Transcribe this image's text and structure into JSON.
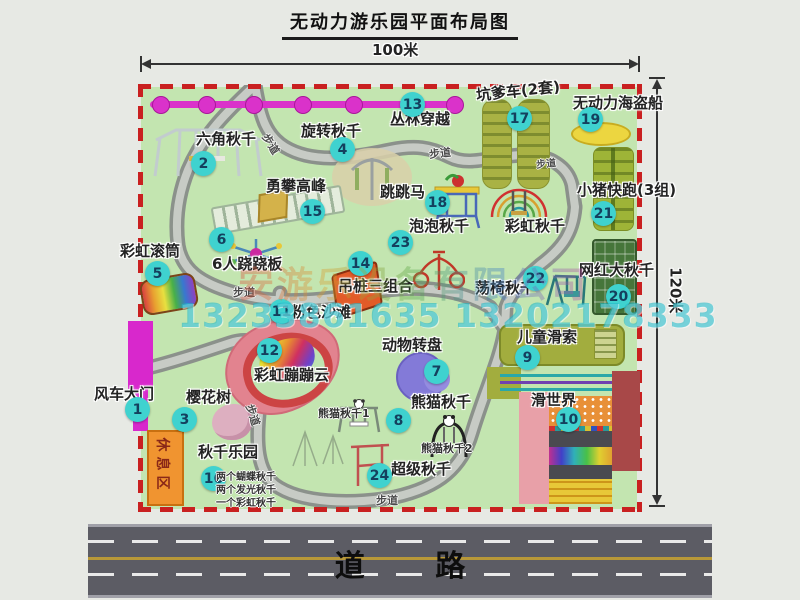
{
  "title": "无动力游乐园平面布局图",
  "dims": {
    "width": "100米",
    "height": "120米"
  },
  "road": {
    "label": "道 路"
  },
  "watermark": {
    "company": "安游乐设备有限公司",
    "phones": "13233861635 13202178333"
  },
  "map": {
    "path_label": "步道",
    "rest_area": "休息区",
    "rainbow_swing_label": "彩虹秋千",
    "panda_swing_1": "熊猫秋千1",
    "panda_swing_2": "熊猫秋千2",
    "swing_park_notes": [
      "两个蝴蝶秋千",
      "两个发光秋千",
      "一个彩虹秋千"
    ]
  },
  "attractions": [
    {
      "num": "1",
      "label": "风车大门"
    },
    {
      "num": "2",
      "label": "六角秋千"
    },
    {
      "num": "3",
      "label": "樱花树"
    },
    {
      "num": "4",
      "label": "旋转秋千"
    },
    {
      "num": "5",
      "label": "彩虹滚筒"
    },
    {
      "num": "6",
      "label": "6人跷跷板"
    },
    {
      "num": "7",
      "label": "动物转盘"
    },
    {
      "num": "8",
      "label": "熊猫秋千"
    },
    {
      "num": "9",
      "label": "儿童滑索"
    },
    {
      "num": "10",
      "label": "滑世界"
    },
    {
      "num": "11",
      "label": "粉色沙滩"
    },
    {
      "num": "12",
      "label": "彩虹蹦蹦云"
    },
    {
      "num": "13",
      "label": "丛林穿越"
    },
    {
      "num": "14",
      "label": "吊桩三组合"
    },
    {
      "num": "15",
      "label": "勇攀高峰"
    },
    {
      "num": "16",
      "label": "秋千乐园"
    },
    {
      "num": "17",
      "label": "坑爹车(2套)"
    },
    {
      "num": "18",
      "label": "跳跳马"
    },
    {
      "num": "19",
      "label": "无动力海盗船"
    },
    {
      "num": "20",
      "label": "网红大秋千"
    },
    {
      "num": "21",
      "label": "小猪快跑(3组)"
    },
    {
      "num": "22",
      "label": "荡椅秋千"
    },
    {
      "num": "23",
      "label": "泡泡秋千"
    },
    {
      "num": "24",
      "label": "超级秋千"
    }
  ]
}
